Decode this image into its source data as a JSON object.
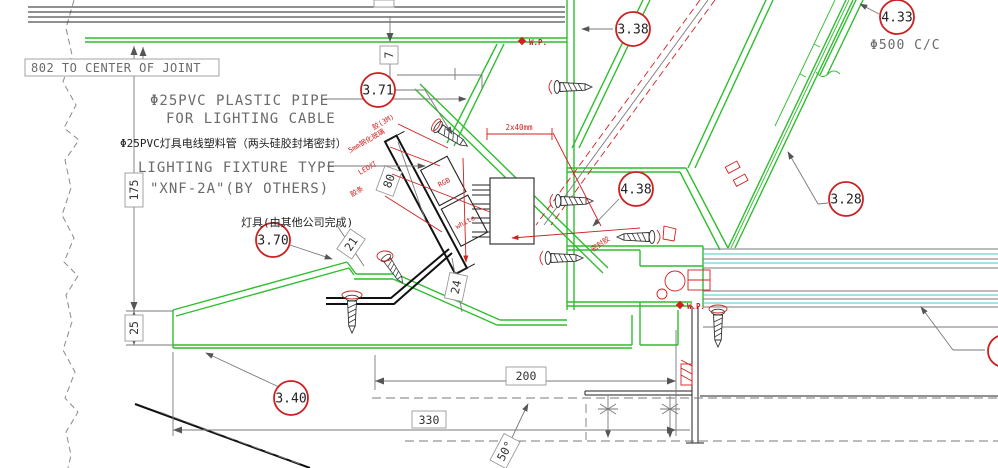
{
  "drawing": {
    "notes": {
      "joint_note": "802 TO CENTER OF JOINT",
      "pipe_note_en1": "Φ25PVC PLASTIC PIPE",
      "pipe_note_en2": "FOR LIGHTING CABLE",
      "pipe_note_cn": "Φ25PVC灯具电线塑料管（两头硅胶封堵密封）",
      "fixture_note_en1": "LIGHTING FIXTURE TYPE",
      "fixture_note_en2": "\"XNF-2A\"(BY OTHERS)",
      "fixture_note_cn": "灯具(由其他公司完成)",
      "anchor_spacing": "Φ500 C/C",
      "wp_top": "W.P.",
      "wp_mid": "W.P."
    },
    "callouts": {
      "c338": "3.38",
      "c433": "4.33",
      "c371": "3.71",
      "c438": "4.38",
      "c328": "3.28",
      "c370": "3.70",
      "c340": "3.40"
    },
    "dimensions": {
      "d7": "7",
      "d175": "175",
      "d25": "25",
      "d80": "80",
      "d21": "21",
      "d24": "24",
      "d200": "200",
      "d330": "330",
      "d_angle": "50°",
      "d_led": "2x40mm"
    },
    "red_labels": {
      "tape": "胶(3M)",
      "glass": "5mm钢化玻璃",
      "led": "LED灯",
      "strip": "胶条",
      "sealant": "密封胶",
      "rgb": "RGB",
      "white": "white"
    },
    "colors": {
      "green": "#2fbe2f",
      "red": "#d21f1f",
      "cyan": "#49c9c9",
      "gray": "#6a6a6a",
      "dark": "#1c1c1c"
    }
  }
}
